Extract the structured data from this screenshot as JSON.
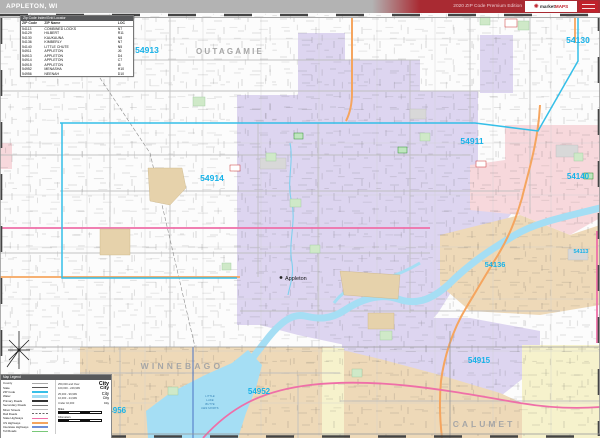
{
  "header": {
    "title": "APPLETON, WI",
    "edition": "2020 ZIP Code Premium Edition",
    "logo_brand_1": "market",
    "logo_brand_2": "MAPS"
  },
  "zip_index": {
    "title": "Zip Code Index/Grid Locator",
    "columns": [
      "ZIP Code",
      "ZIP Name",
      "LOC"
    ],
    "rows": [
      [
        "54113",
        "COMBINED LOCKS",
        "N7"
      ],
      [
        "54129",
        "HILBERT",
        "R11"
      ],
      [
        "54130",
        "KAUKAUNA",
        "N8"
      ],
      [
        "54136",
        "KIMBERLY",
        "N7"
      ],
      [
        "54140",
        "LITTLE CHUTE",
        "N5"
      ],
      [
        "54911",
        "APPLETON",
        "J6"
      ],
      [
        "54913",
        "APPLETON",
        "D4"
      ],
      [
        "54914",
        "APPLETON",
        "C7"
      ],
      [
        "54915",
        "APPLETON",
        "I8"
      ],
      [
        "54952",
        "MENASHA",
        "H10"
      ],
      [
        "54956",
        "NEENAH",
        "D10"
      ]
    ]
  },
  "map": {
    "zip_labels": {
      "z54913": "54913",
      "z54130": "54130",
      "z54911": "54911",
      "z54914": "54914",
      "z54140": "54140",
      "z54113": "54113",
      "z54136": "54136",
      "z54915": "54915",
      "z54952": "54952",
      "z54956": "54956"
    },
    "counties": {
      "outagamie": "OUTAGAMIE",
      "winnebago": "WINNEBAGO",
      "calumet": "CALUMET"
    },
    "city": "Appleton",
    "lake_lines": [
      "LITTLE",
      "LAKE",
      "BUTTE",
      "DES MORTS"
    ]
  },
  "legend": {
    "title": "Map Legend",
    "items": [
      {
        "label": "County"
      },
      {
        "label": "State"
      },
      {
        "label": "ZIP Code"
      },
      {
        "label": "Water"
      },
      {
        "label": "Primary Roads"
      },
      {
        "label": "Secondary Roads"
      },
      {
        "label": "Minor Streets"
      },
      {
        "label": "Rail Roads"
      },
      {
        "label": "State Highways"
      },
      {
        "label": "US Highways"
      },
      {
        "label": "Interstate Highways"
      },
      {
        "label": "Toll Roads"
      }
    ],
    "city_sizes": [
      {
        "range": "250,000 and Over",
        "sample": "City"
      },
      {
        "range": "100,000 - 249,999",
        "sample": "City"
      },
      {
        "range": "25,000 - 99,999",
        "sample": "City"
      },
      {
        "range": "10,000 - 24,999",
        "sample": "City"
      },
      {
        "range": "Under 10,000",
        "sample": "City"
      }
    ],
    "scale_miles": "Miles",
    "scale_km": "Kilometers"
  },
  "colors": {
    "accent_red": "#a92a32",
    "zip_label_cyan": "#17b2e8",
    "county_label_gray": "#a6a6a6",
    "fill_lavender": "#ddd5f0",
    "fill_pink": "#f7d8dc",
    "fill_tan": "#eed9b8",
    "fill_yellow": "#f6f2cc",
    "water_blue": "#a5def4",
    "road_orange": "#f5a55f",
    "road_magenta": "#ef6fa8"
  }
}
